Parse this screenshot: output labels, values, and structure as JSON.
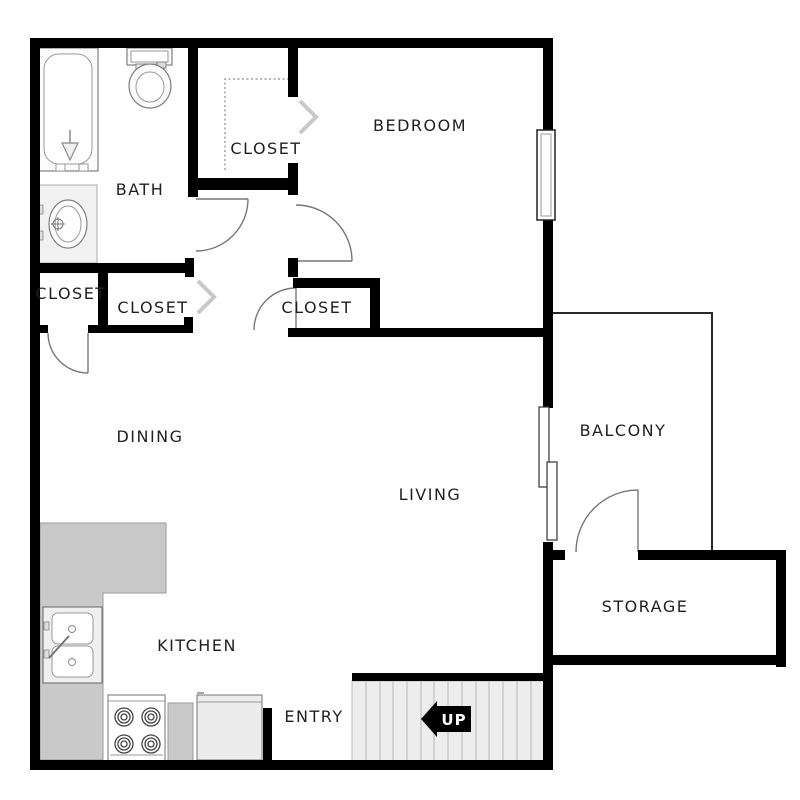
{
  "floorplan": {
    "labels": {
      "bath": "BATH",
      "closet_bath": "CLOSET",
      "bedroom": "BEDROOM",
      "closet_left": "CLOSET",
      "closet_middle": "CLOSET",
      "closet_bedroom": "CLOSET",
      "dining": "DINING",
      "living": "LIVING",
      "balcony": "BALCONY",
      "storage": "STORAGE",
      "kitchen": "KITCHEN",
      "entry": "ENTRY",
      "stairs_direction": "UP"
    },
    "colors": {
      "wall": "#000000",
      "background": "#ffffff",
      "counter": "#c9c9c9",
      "stairs_fill": "#ededed",
      "stair_tread_line": "#b8b8b8",
      "fixture_stroke": "#808080",
      "door_arc": "#777777",
      "chevron": "#c8c8c8",
      "balcony_line": "#2a2a2a",
      "label_text": "#1f1f1f",
      "up_arrow": "#000000",
      "up_text": "#ffffff"
    },
    "fixtures": [
      "bathtub",
      "toilet",
      "vanity-sink",
      "kitchen-counter",
      "kitchen-sink",
      "stove",
      "refrigerator",
      "stairs",
      "up-arrow",
      "window",
      "sliding-door"
    ]
  }
}
